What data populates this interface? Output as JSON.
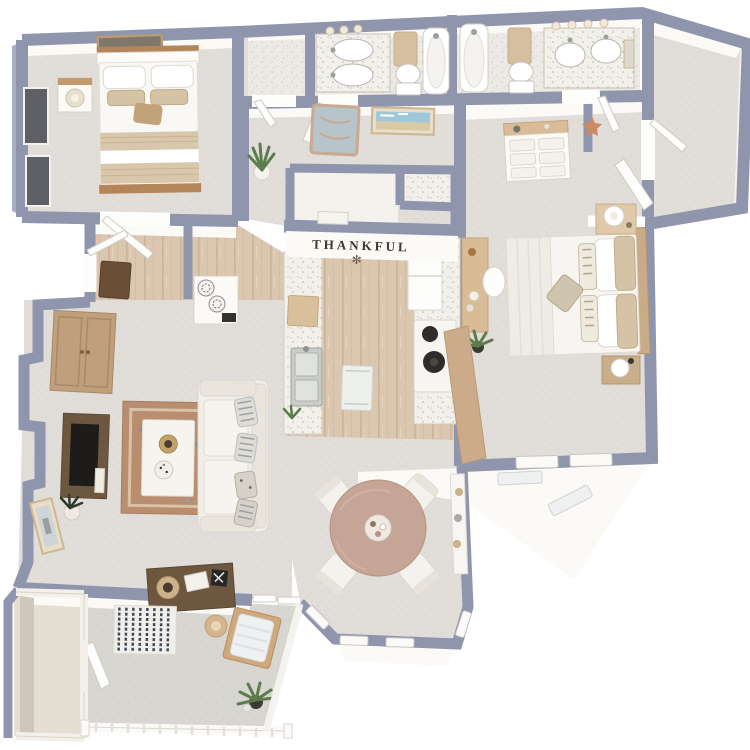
{
  "scene": {
    "kind": "3d-top-down-floor-plan-rendering",
    "background": "#ffffff",
    "rooms": [
      "bedroom-2",
      "bedroom-2-closet",
      "bathroom-1",
      "bathroom-2",
      "walk-in-closet",
      "dressing-vestibule",
      "hallway",
      "master-bedroom",
      "kitchen",
      "pantry-closet",
      "laundry-closet",
      "entry",
      "living-room",
      "dining-area",
      "patio",
      "patio-storage"
    ],
    "furniture": [
      "queen-bed",
      "nightstand",
      "table-lamp",
      "wall-art",
      "double-vanity",
      "toilet",
      "bathtub",
      "towel",
      "dresser",
      "king-bed",
      "desk",
      "desk-chair",
      "refrigerator",
      "range",
      "kitchen-sink",
      "bar-counter",
      "round-dining-table",
      "dining-chairs",
      "sofa",
      "coffee-table",
      "tv-console",
      "armoire",
      "area-rug",
      "console-table",
      "lounge-chair",
      "side-table",
      "potted-plant",
      "striped-outdoor-rug",
      "railing"
    ]
  },
  "texts": {
    "wall_quote": "THANKFUL",
    "wall_quote_decor_glyph": "✻"
  },
  "colors": {
    "wall_top": "#8f95ad",
    "wall_top_light": "#a9aec2",
    "wall_face": "#fbfaf6",
    "carpet": "#e1deda",
    "wood_floor": "#d9c5ae",
    "bath_floor": "#efede7",
    "counter": "#f2f0ea",
    "patio_floor": "#d6d5d0",
    "cabinet_wood": "#bf9f7d",
    "dark_wood": "#6e573f",
    "bar_wood": "#cbab89",
    "dining_table_wood": "#c4a596",
    "rug_terracotta": "#b98d6f",
    "rug_stripe_navy": "#41495c",
    "bedding_tan": "#d5c3a5",
    "plant_green": "#5d7c4c",
    "quote_text": "#3e362c"
  }
}
